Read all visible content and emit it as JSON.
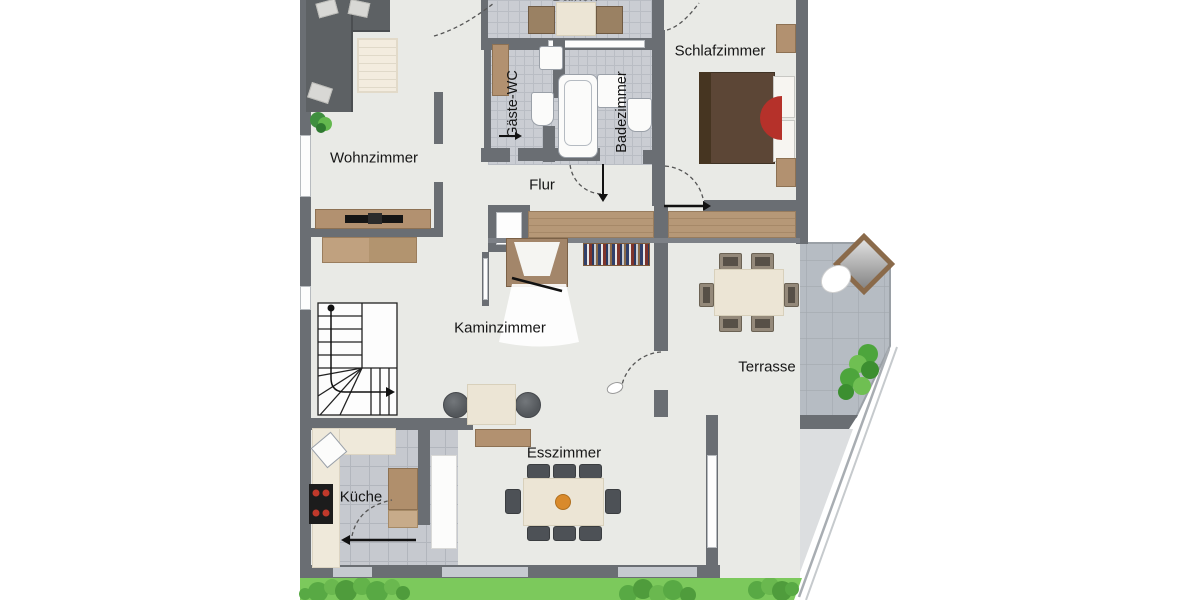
{
  "plan": {
    "type": "apartment-floor-plan",
    "rooms": [
      {
        "id": "wohnzimmer",
        "label": "Wohnzimmer"
      },
      {
        "id": "gaeste_wc",
        "label": "Gäste-WC"
      },
      {
        "id": "badezimmer",
        "label": "Badezimmer"
      },
      {
        "id": "schlafzimmer",
        "label": "Schlafzimmer"
      },
      {
        "id": "flur",
        "label": "Flur"
      },
      {
        "id": "kaminzimmer",
        "label": "Kaminzimmer"
      },
      {
        "id": "terrasse",
        "label": "Terrasse"
      },
      {
        "id": "esszimmer",
        "label": "Esszimmer"
      },
      {
        "id": "kueche",
        "label": "Küche"
      },
      {
        "id": "balkon",
        "label": "Balkon"
      }
    ],
    "colors": {
      "wall": "#6a6e73",
      "floor": "#e9eae6",
      "tile": "#cacdd3",
      "terrace_tile": "#b6bcc3",
      "grass": "#7cc95c",
      "wood": "#b69877",
      "bed_red": "#b5312a"
    }
  }
}
